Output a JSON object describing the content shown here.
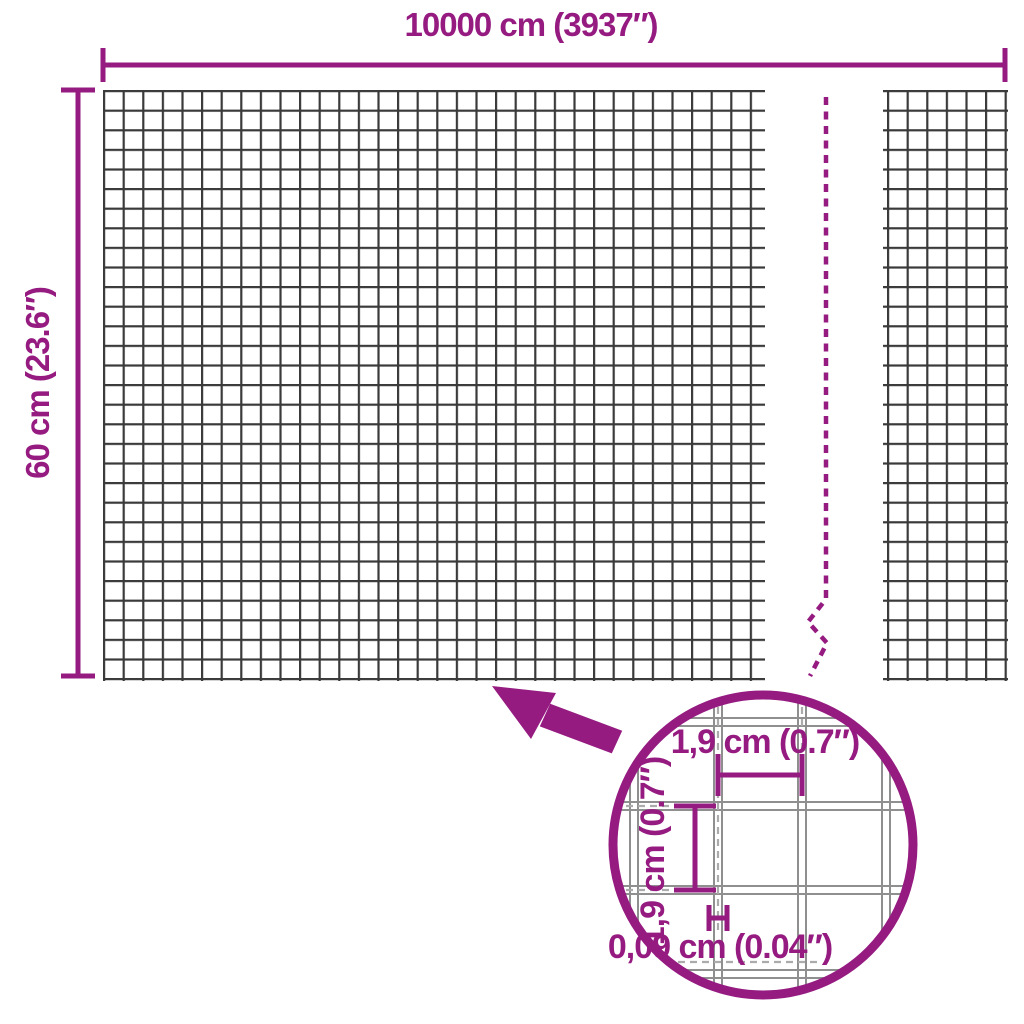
{
  "dimensions": {
    "width_label": "10000 cm (3937″)",
    "height_label": "60 cm (23.6″)"
  },
  "detail": {
    "mesh_width_label": "1,9 cm (0.7″)",
    "mesh_height_label": "1,9 cm (0.7″)",
    "wire_thickness_label": "0,09 cm (0.04″)"
  },
  "colors": {
    "accent": "#951b81",
    "mesh": "#3a3a3a",
    "wire": "#8f8f8f",
    "guide": "#ababab",
    "background": "#ffffff"
  }
}
